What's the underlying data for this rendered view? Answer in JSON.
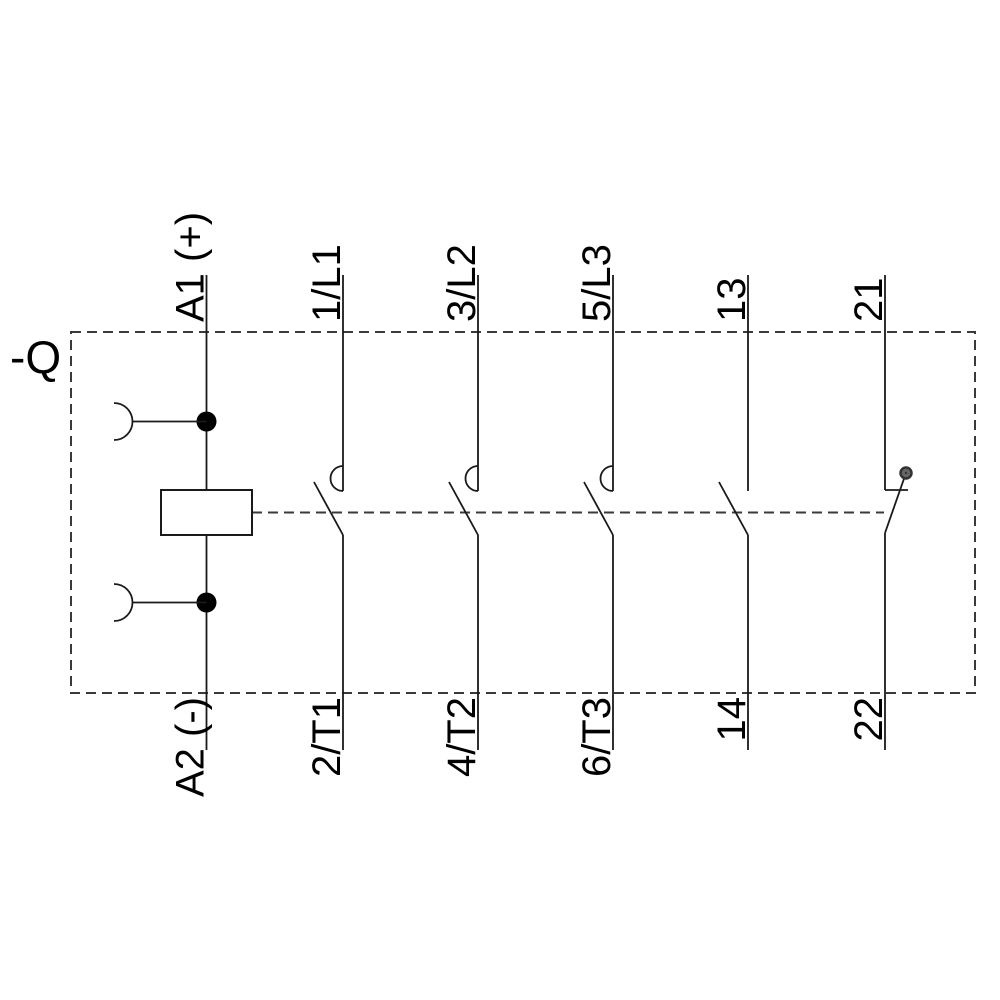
{
  "designation": "-Q",
  "terminals": {
    "coil": {
      "top": "A1 (+)",
      "bottom": "A2 (-)"
    },
    "pole1": {
      "top": "1/L1",
      "bottom": "2/T1"
    },
    "pole2": {
      "top": "3/L2",
      "bottom": "4/T2"
    },
    "pole3": {
      "top": "5/L3",
      "bottom": "6/T3"
    },
    "aux_no": {
      "top": "13",
      "bottom": "14"
    },
    "aux_nc": {
      "top": "21",
      "bottom": "22"
    }
  },
  "colors": {
    "line": "#1a1a1a",
    "dashed_line": "#3a3a3a",
    "background": "#ffffff",
    "pivot_fill": "#666666",
    "text": "#000000"
  }
}
